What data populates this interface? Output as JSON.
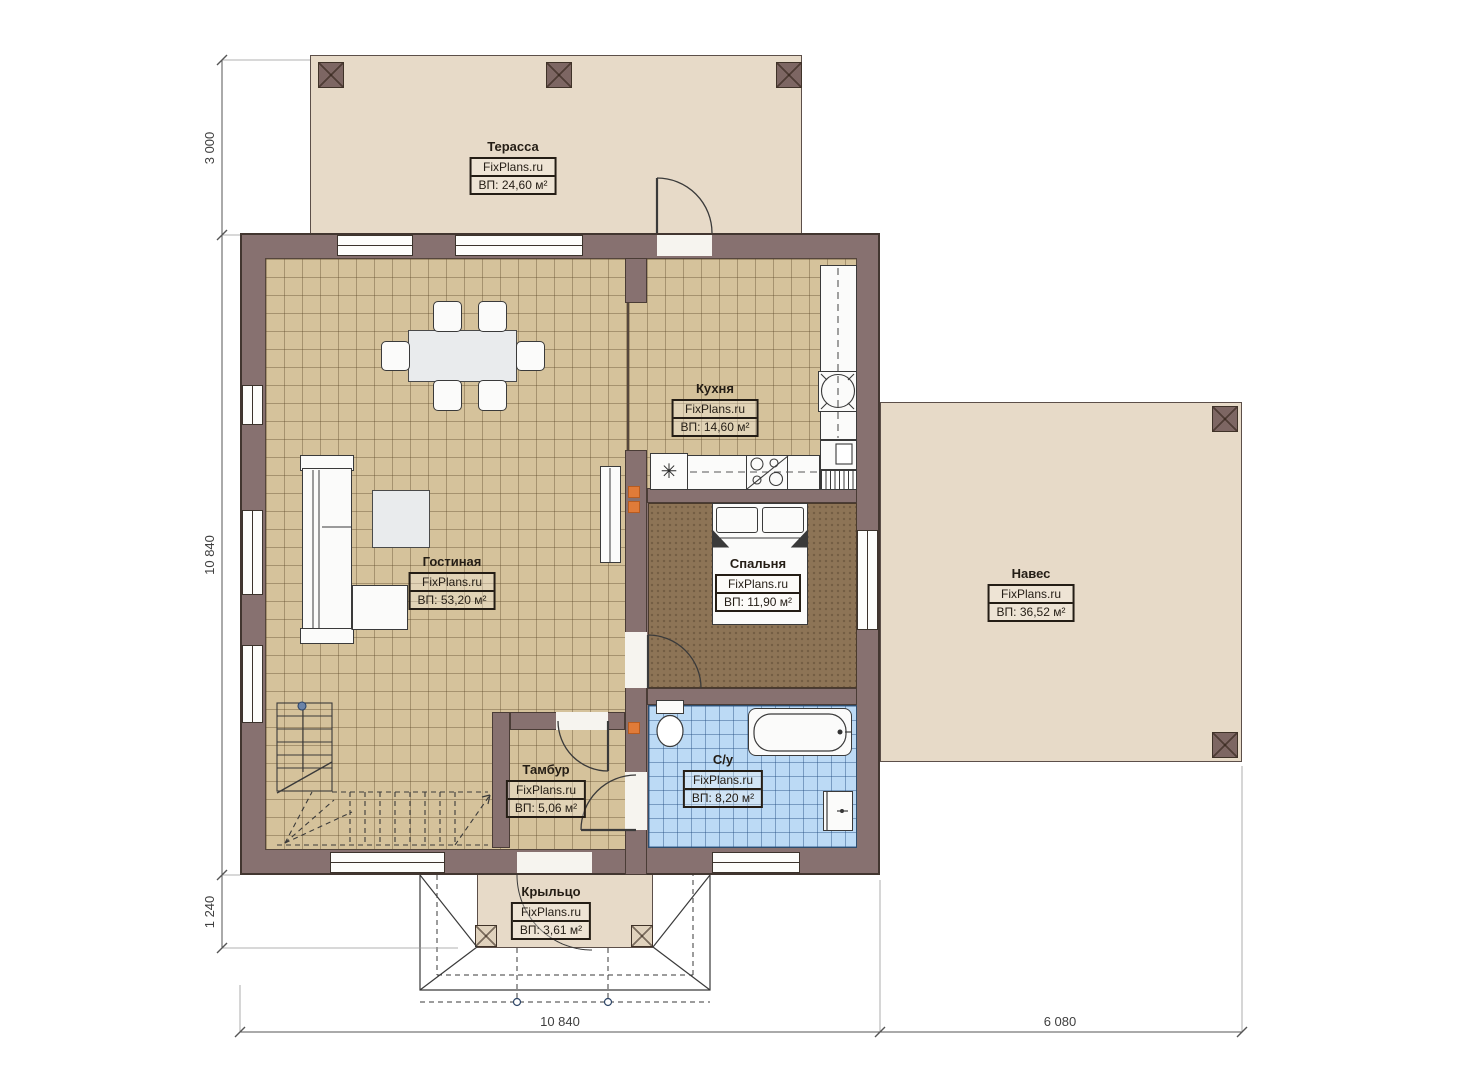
{
  "plan": {
    "title": "floor-plan",
    "rooms": [
      {
        "id": "terrace",
        "name": "Терасса",
        "brand": "FixPlans.ru",
        "area": "ВП: 24,60 м²"
      },
      {
        "id": "kitchen",
        "name": "Кухня",
        "brand": "FixPlans.ru",
        "area": "ВП: 14,60 м²"
      },
      {
        "id": "living",
        "name": "Гостиная",
        "brand": "FixPlans.ru",
        "area": "ВП: 53,20 м²"
      },
      {
        "id": "bedroom",
        "name": "Спальня",
        "brand": "FixPlans.ru",
        "area": "ВП: 11,90 м²"
      },
      {
        "id": "canopy",
        "name": "Навес",
        "brand": "FixPlans.ru",
        "area": "ВП: 36,52 м²"
      },
      {
        "id": "vestibule",
        "name": "Тамбур",
        "brand": "FixPlans.ru",
        "area": "ВП: 5,06 м²"
      },
      {
        "id": "bathroom",
        "name": "С/у",
        "brand": "FixPlans.ru",
        "area": "ВП: 8,20 м²"
      },
      {
        "id": "porch",
        "name": "Крыльцо",
        "brand": "FixPlans.ru",
        "area": "ВП: 3,61 м²"
      }
    ],
    "dimensions": {
      "left_top": "3 000",
      "left_middle": "10 840",
      "left_bottom": "1 240",
      "bottom_left": "10 840",
      "bottom_right": "6 080"
    },
    "icons": {
      "fridge": "✳"
    },
    "colors": {
      "wall": "#877170",
      "floor_tile": "#d5c29b",
      "bedroom_floor": "#8d7456",
      "bathroom_tile": "#bcdaf5",
      "outdoor": "#e7dac8",
      "vent_marker": "#e07b39"
    }
  }
}
